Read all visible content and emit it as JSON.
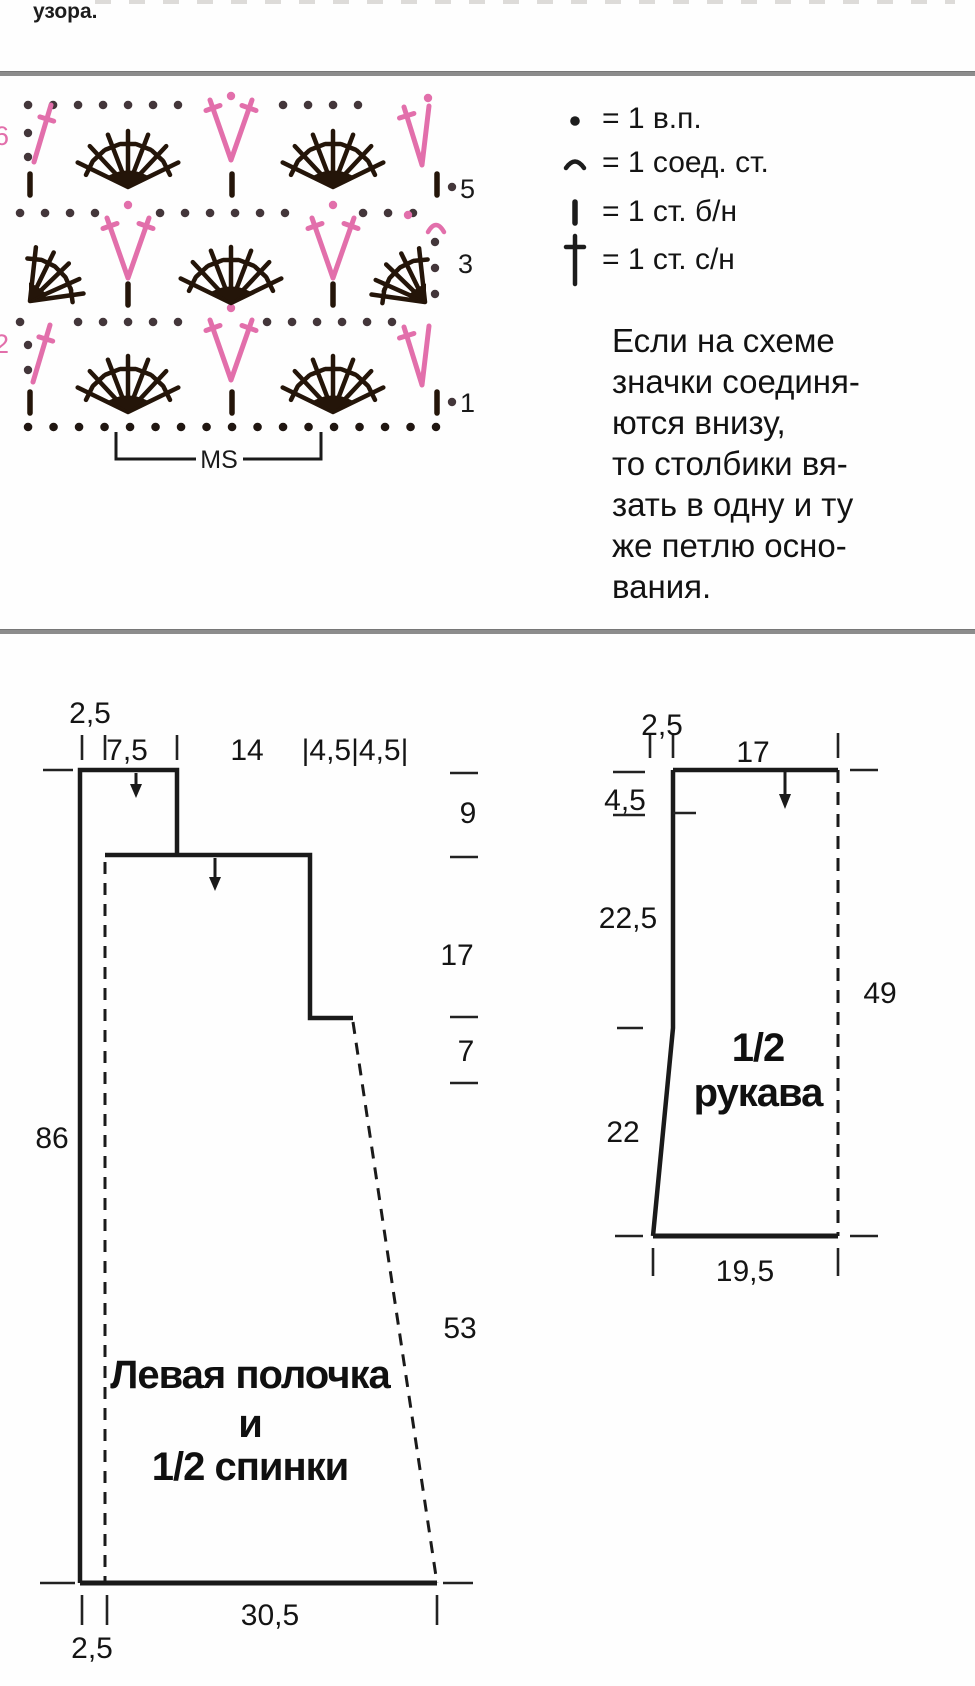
{
  "page": {
    "fragment": "узора."
  },
  "chart": {
    "ms_label": "MS",
    "row_labels": {
      "r1": "1",
      "r2": "2",
      "r3": "3",
      "r5": "5",
      "r6": "6"
    }
  },
  "legend": {
    "items": [
      {
        "symbol": "chain-dot",
        "text": "= 1 в.п."
      },
      {
        "symbol": "slip-stitch-arc",
        "text": "= 1 соед. ст."
      },
      {
        "symbol": "single-crochet-bar",
        "text": "= 1 ст. б/н"
      },
      {
        "symbol": "double-crochet-cross",
        "text": "= 1 ст. с/н"
      }
    ],
    "note_lines": [
      "Если на схеме",
      "значки соединя-",
      "ются внизу,",
      "то столбики вя-",
      "зать в одну и ту",
      "же петлю осно-",
      "вания."
    ]
  },
  "left_piece": {
    "title_lines": [
      "Левая полочка",
      "и",
      "1/2 спинки"
    ],
    "m": {
      "top_small": "2,5",
      "shoulder": "7,5",
      "neck": "14",
      "armhole": "|4,5|4,5|",
      "side_top": "9",
      "side_mid": "17",
      "side_small": "7",
      "height": "86",
      "side_bottom": "53",
      "bottom_width": "30,5",
      "bottom_small": "2,5"
    }
  },
  "right_piece": {
    "title_lines": [
      "1/2",
      "рукава"
    ],
    "m": {
      "top_small": "2,5",
      "top_width": "17",
      "left_top": "4,5",
      "left_mid": "22,5",
      "left_bottom": "22",
      "height": "49",
      "bottom_width": "19,5"
    }
  }
}
